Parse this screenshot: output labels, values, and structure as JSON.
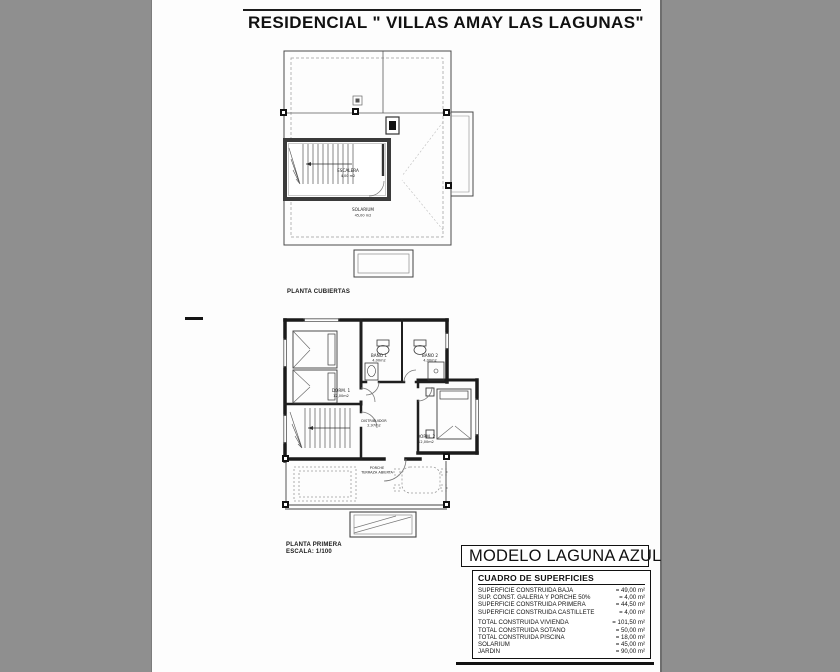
{
  "page": {
    "title": "RESIDENCIAL \" VILLAS AMAY LAS LAGUNAS\""
  },
  "roof_plan": {
    "label": "PLANTA CUBIERTAS",
    "escalera_label": "ESCALERA",
    "escalera_area": "4,00 m2",
    "solarium_label": "SOLARIUM",
    "solarium_area": "45,00 m2"
  },
  "first_plan": {
    "label": "PLANTA PRIMERA",
    "scale": "ESCALA: 1/100",
    "dorm1_label": "DORM. 1",
    "dorm1_area": "12,00m2",
    "bano1_label": "BAÑO 1",
    "bano1_area": "4,00m2",
    "bano2_label": "BAÑO 2",
    "bano2_area": "4,00m2",
    "dorm2_label": "DORM. 2",
    "dorm2_area": "12,00m2",
    "distribuidor_label": "DISTRIBUIDOR",
    "distribuidor_area": "2,97m2",
    "porche_label": "PORCHE",
    "porche_area": "TERRAZA ABIERTA"
  },
  "title_block": {
    "model": "MODELO LAGUNA AZUL",
    "table_title": "CUADRO DE SUPERFICIES",
    "rows_a": [
      {
        "label": "SUPERFICIE CONSTRUIDA BAJA",
        "value": "= 49,00 m²"
      },
      {
        "label": "SUP. CONST. GALERIA Y PORCHE 50%",
        "value": "= 4,00 m²"
      },
      {
        "label": "SUPERFICIE CONSTRUIDA PRIMERA",
        "value": "= 44,50 m²"
      },
      {
        "label": "SUPERFICIE CONSTRUIDA CASTILLETE",
        "value": "= 4,00 m²"
      }
    ],
    "rows_b": [
      {
        "label": "TOTAL CONSTRUIDA VIVIENDA",
        "value": "= 101,50 m²"
      },
      {
        "label": "TOTAL CONSTRUIDA SOTANO",
        "value": "= 50,00 m²"
      },
      {
        "label": "TOTAL CONSTRUIDA PISCINA",
        "value": "= 18,00 m²"
      },
      {
        "label": "SOLARIUM",
        "value": "= 45,00 m²"
      },
      {
        "label": "JARDIN",
        "value": "= 90,00 m²"
      }
    ]
  }
}
